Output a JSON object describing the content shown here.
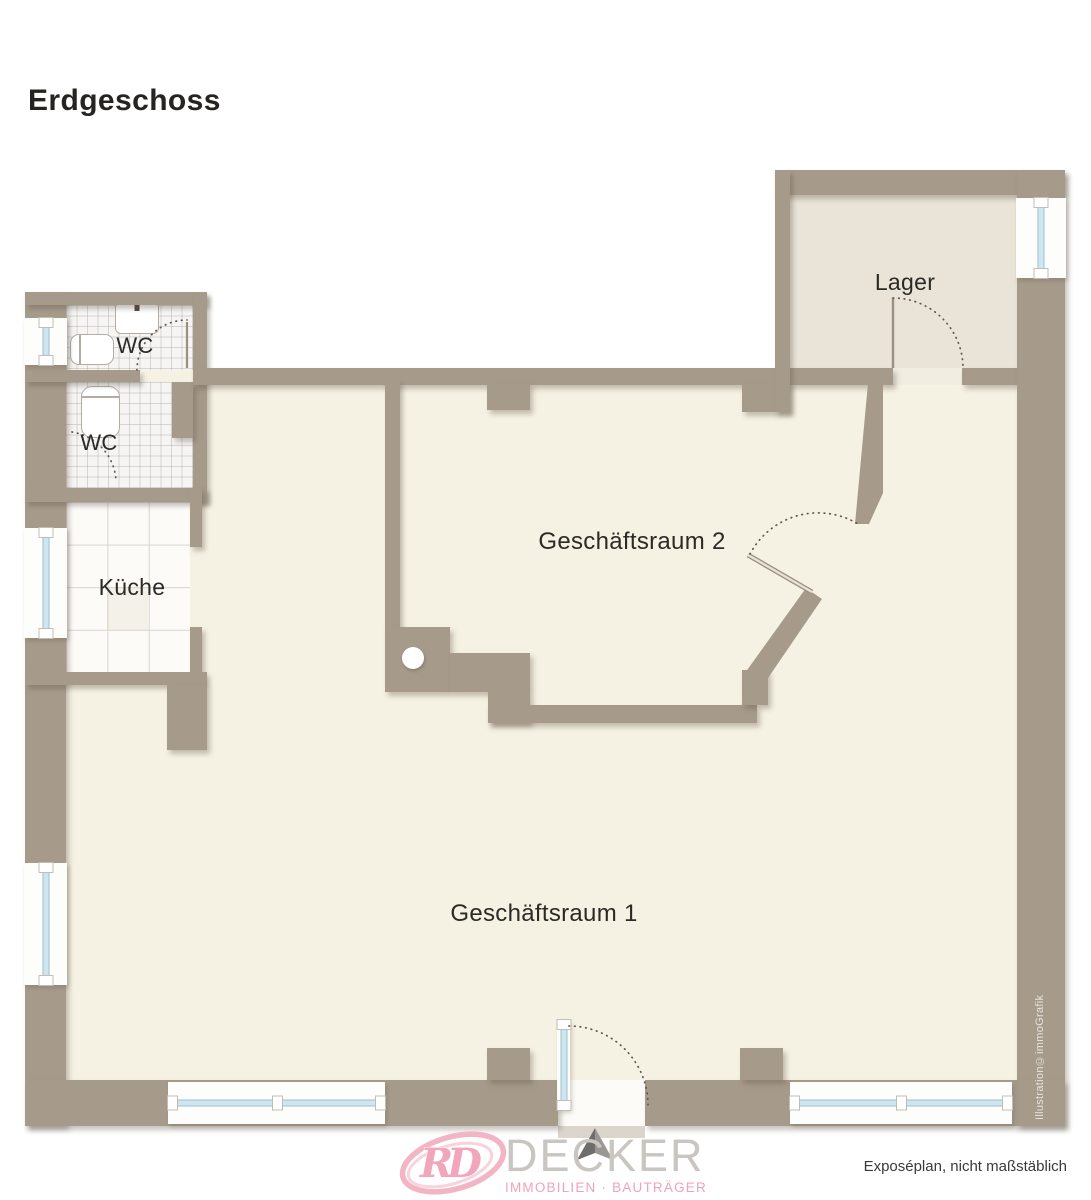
{
  "title": "Erdgeschoss",
  "rooms": {
    "wc1": {
      "label": "WC"
    },
    "wc2": {
      "label": "WC"
    },
    "kueche": {
      "label": "Küche"
    },
    "lager": {
      "label": "Lager"
    },
    "raum2": {
      "label": "Geschäftsraum 2"
    },
    "raum1": {
      "label": "Geschäftsraum 1"
    }
  },
  "footer": {
    "note": "Exposéplan, nicht maßstäblich"
  },
  "watermark": "Illustration©immoGrafik",
  "logo": {
    "monogram": "RD",
    "name": "DECKER",
    "tagline": "IMMOBILIEN · BAUTRÄGER"
  },
  "colors": {
    "wall": "#a69b8b",
    "floor_main": "#f6f2e3",
    "floor_lager": "#e9e4d7",
    "window_glass": "#cde6f0",
    "door_arc": "#5f584e",
    "label_text": "#2c2a26",
    "logo_gray": "#c9c6c2",
    "logo_pink": "#f1a6bb"
  }
}
